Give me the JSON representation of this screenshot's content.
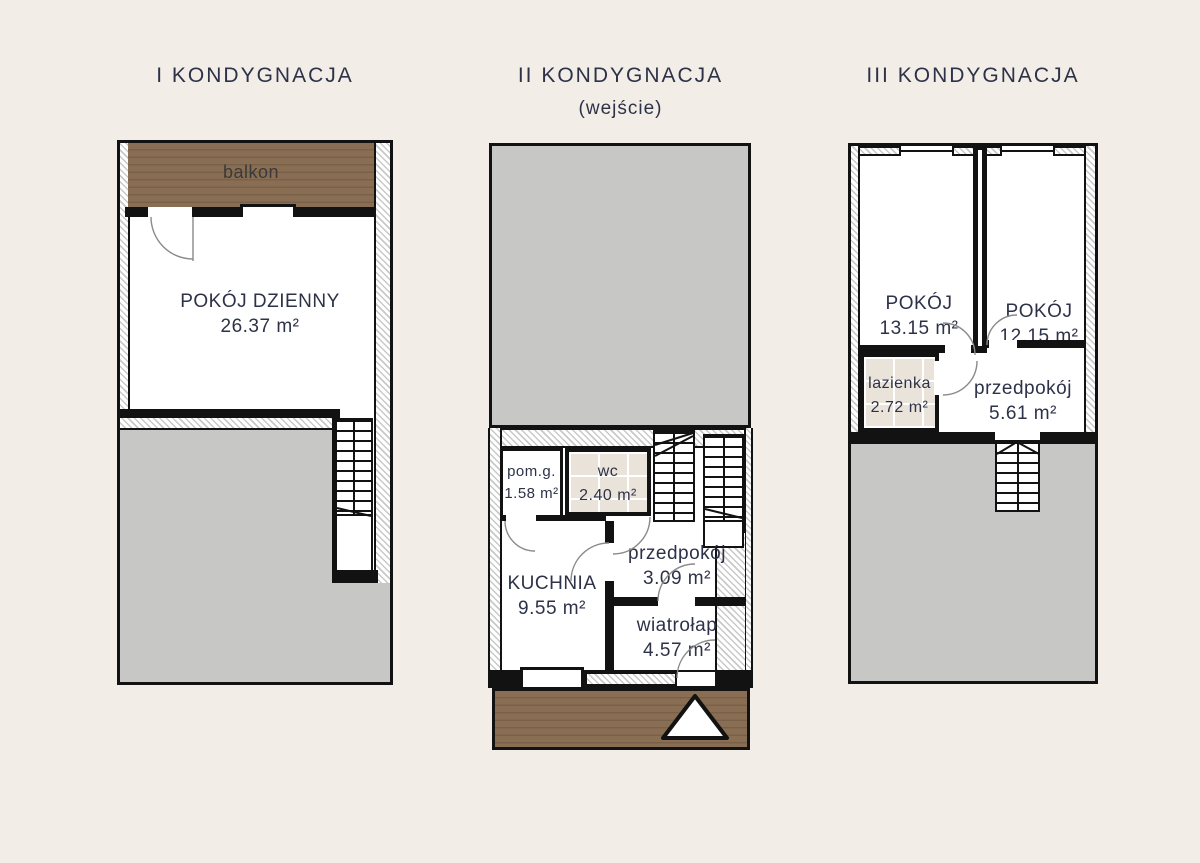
{
  "page": {
    "background_color": "#f2ede7",
    "text_color": "#2d3248",
    "wall_color": "#121212",
    "neighbor_fill_color": "#c7c8c5",
    "wood_color": "#8a6e53",
    "tile_color": "#eae3d9"
  },
  "floors": [
    {
      "title": "I KONDYGNACJA",
      "rooms": [
        {
          "name": "balkon",
          "area": ""
        },
        {
          "name": "POKÓJ DZIENNY",
          "area": "26.37 m²"
        }
      ]
    },
    {
      "title": "II KONDYGNACJA",
      "subtitle": "(wejście)",
      "rooms": [
        {
          "name": "pom.g.",
          "area": "1.58 m²"
        },
        {
          "name": "wc",
          "area": "2.40 m²"
        },
        {
          "name": "przedpokój",
          "area": "3.09 m²"
        },
        {
          "name": "KUCHNIA",
          "area": "9.55 m²"
        },
        {
          "name": "wiatrołap",
          "area": "4.57 m²"
        }
      ]
    },
    {
      "title": "III KONDYGNACJA",
      "rooms": [
        {
          "name": "POKÓJ",
          "area": "13.15 m²"
        },
        {
          "name": "POKÓJ",
          "area": "12.15 m²"
        },
        {
          "name": "lazienka",
          "area": "2.72 m²"
        },
        {
          "name": "przedpokój",
          "area": "5.61 m²"
        }
      ]
    }
  ]
}
